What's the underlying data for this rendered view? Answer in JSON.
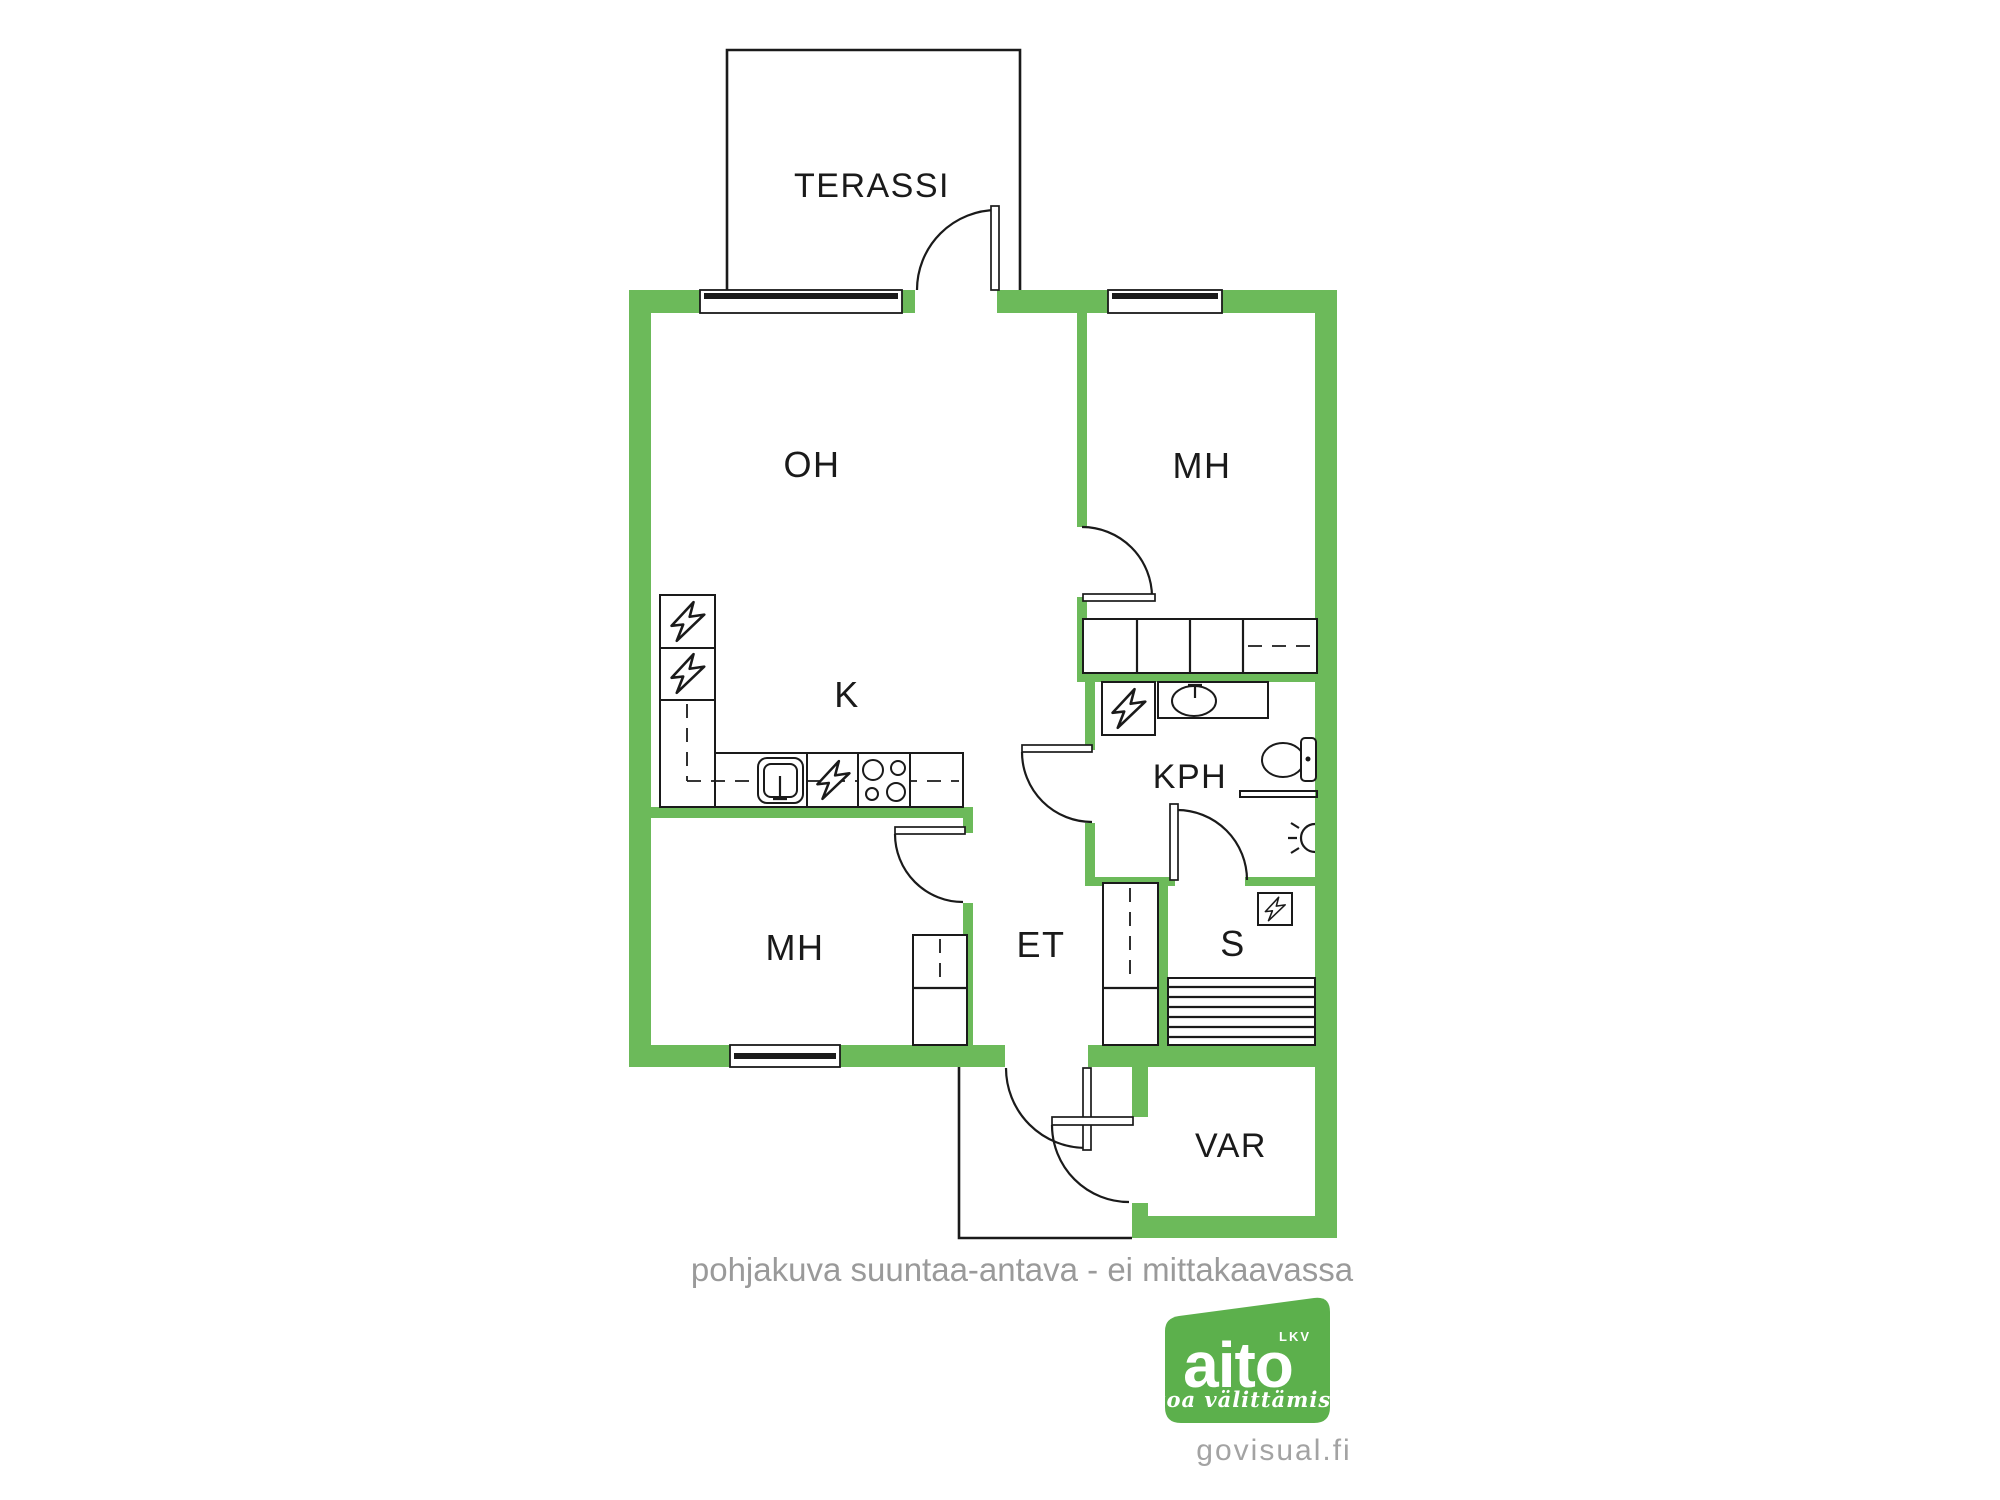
{
  "canvas": {
    "width": 2000,
    "height": 1500,
    "background": "#ffffff"
  },
  "colors": {
    "wall_green": "#6CBA5A",
    "logo_green": "#5CB04C",
    "line_black": "#1A1A1A",
    "note_gray": "#9A9A9A",
    "site_gray": "#A3A3A3"
  },
  "rooms": {
    "terrace": {
      "label": "TERASSI"
    },
    "living": {
      "label": "OH"
    },
    "bedroom_top": {
      "label": "MH"
    },
    "kitchen": {
      "label": "K"
    },
    "bathroom": {
      "label": "KPH"
    },
    "bedroom_bottom": {
      "label": "MH"
    },
    "entry": {
      "label": "ET"
    },
    "sauna": {
      "label": "S"
    },
    "storage": {
      "label": "VAR"
    }
  },
  "icons": {
    "lightning": "electric-appliance-icon",
    "wall_lamp": "wall-light-icon"
  },
  "footer": {
    "note": "pohjakuva suuntaa-antava - ei mittakaavassa"
  },
  "logo": {
    "brand": "aito",
    "suffix": "LKV",
    "tagline": "Aitoa välittämistä",
    "site": "govisual.fi"
  }
}
